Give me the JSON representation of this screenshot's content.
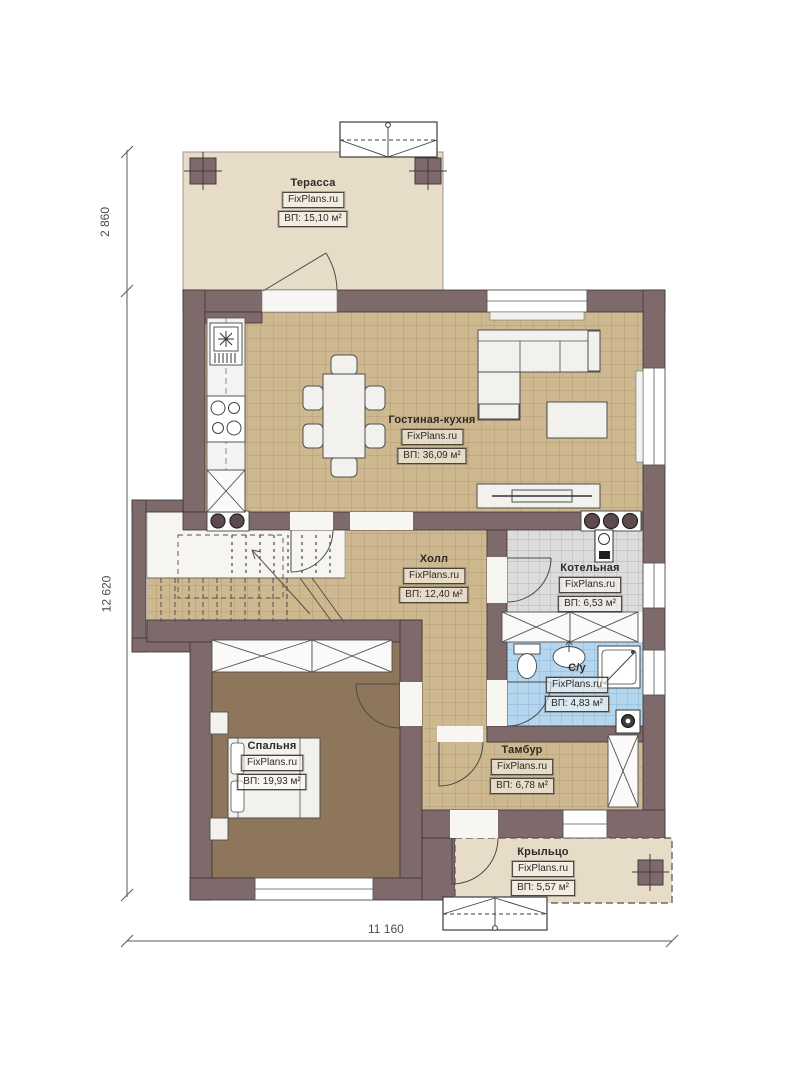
{
  "site_watermark": "FixPlans.ru",
  "rooms": {
    "terrace": {
      "name": "Терасса",
      "brand": "FixPlans.ru",
      "area": "ВП: 15,10 м²"
    },
    "living": {
      "name": "Гостиная-кухня",
      "brand": "FixPlans.ru",
      "area": "ВП: 36,09 м²"
    },
    "hall": {
      "name": "Холл",
      "brand": "FixPlans.ru",
      "area": "ВП: 12,40 м²"
    },
    "boiler": {
      "name": "Котельная",
      "brand": "FixPlans.ru",
      "area": "ВП: 6,53 м²"
    },
    "wc": {
      "name": "С/у",
      "brand": "FixPlans.ru",
      "area": "ВП: 4,83 м²"
    },
    "vestibule": {
      "name": "Тамбур",
      "brand": "FixPlans.ru",
      "area": "ВП: 6,78 м²"
    },
    "bedroom": {
      "name": "Спальня",
      "brand": "FixPlans.ru",
      "area": "ВП: 19,93 м²"
    },
    "porch": {
      "name": "Крыльцо",
      "brand": "FixPlans.ru",
      "area": "ВП: 5,57 м²"
    }
  },
  "dimensions": {
    "left_top": "2 860",
    "left_main": "12 620",
    "bottom": "11 160"
  },
  "colors": {
    "wall": "#7e696b",
    "tile_tan": "#cdb890",
    "tile_gray": "#dcdcdc",
    "tile_blue": "#b5d6ef",
    "bedroom_floor": "#8d7659",
    "deck_beige": "#e7dcc8"
  }
}
